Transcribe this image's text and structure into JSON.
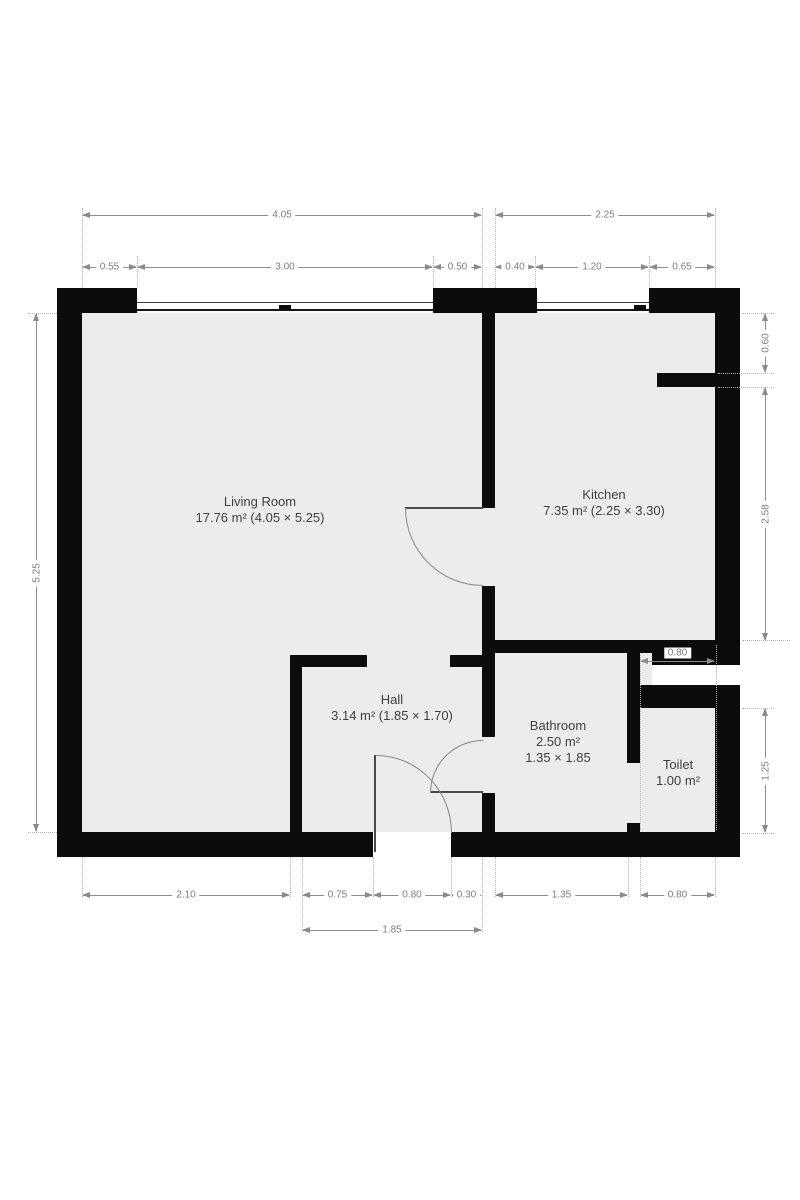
{
  "plan": {
    "type": "apartment-floor-plan",
    "colors": {
      "wall": "#0c0c0c",
      "floor": "#ececec",
      "background": "#ffffff",
      "dimension_line": "#8a8a8a",
      "dimension_text": "#7e7e7e",
      "room_label_text": "#3d4043"
    }
  },
  "rooms": {
    "living": {
      "label": "Living Room",
      "detail": "17.76 m² (4.05 × 5.25)"
    },
    "kitchen": {
      "label": "Kitchen",
      "detail": "7.35 m² (2.25 × 3.30)"
    },
    "hall": {
      "label": "Hall",
      "detail": "3.14 m² (1.85 × 1.70)"
    },
    "bathroom": {
      "label": "Bathroom",
      "area": "2.50 m²",
      "size": "1.35 × 1.85"
    },
    "toilet": {
      "label": "Toilet",
      "area": "1.00 m²"
    }
  },
  "dimensions": {
    "top_main": [
      "4.05",
      "2.25"
    ],
    "top_detail": [
      "0.55",
      "3.00",
      "0.50",
      "0.40",
      "1.20",
      "0.65"
    ],
    "left": [
      "5.25"
    ],
    "right": [
      "0.60",
      "2.58",
      "1.25"
    ],
    "toilet_width": [
      "0.80"
    ],
    "bottom_detail": [
      "2.10",
      "0.75",
      "0.80",
      "0.30",
      "1.35",
      "0.80"
    ],
    "bottom_hall": [
      "1.85"
    ]
  }
}
